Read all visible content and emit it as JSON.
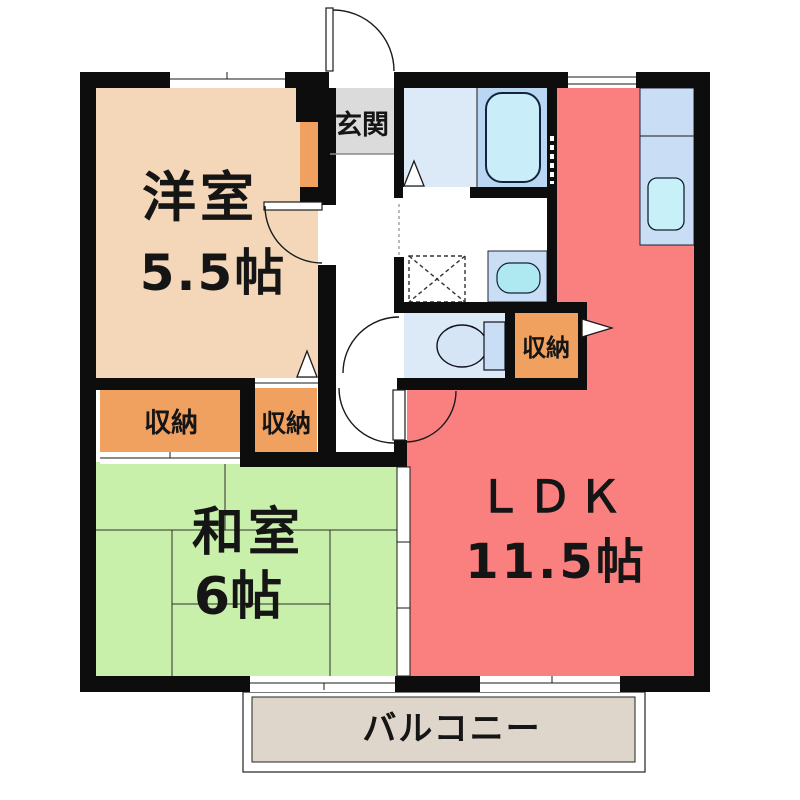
{
  "title": "apartment-floorplan",
  "rooms": {
    "western": {
      "name": "洋室",
      "size": "5.5帖",
      "color": "#f4d7b9"
    },
    "japanese": {
      "name": "和室",
      "size": "6帖",
      "color": "#c9f0aa"
    },
    "ldk": {
      "name": "ＬＤＫ",
      "size": "11.5帖",
      "color": "#fa8080"
    },
    "entrance": {
      "name": "玄関",
      "color": "#dbdbdb"
    },
    "balcony": {
      "name": "バルコニー",
      "color": "#ded6ca"
    }
  },
  "storages": {
    "storage1": {
      "label": "収納"
    },
    "storage2": {
      "label": "収納"
    },
    "storage3": {
      "label": "収納"
    }
  },
  "fixtures": {
    "bathtub": "unit-bath",
    "toilet": "toilet",
    "washbasin": "washbasin",
    "laundry_pan": "washing-machine-space",
    "kitchen_sink": "kitchen-counter"
  },
  "colors": {
    "wall": "#0d0d0d",
    "bath_floor": "#dce9f7",
    "tub_zone": "#b9d7f2",
    "tub": "#c9eef9",
    "counter": "#c9ddf4",
    "sink": "#aee9f2",
    "storage_orange": "#f0a05f"
  }
}
